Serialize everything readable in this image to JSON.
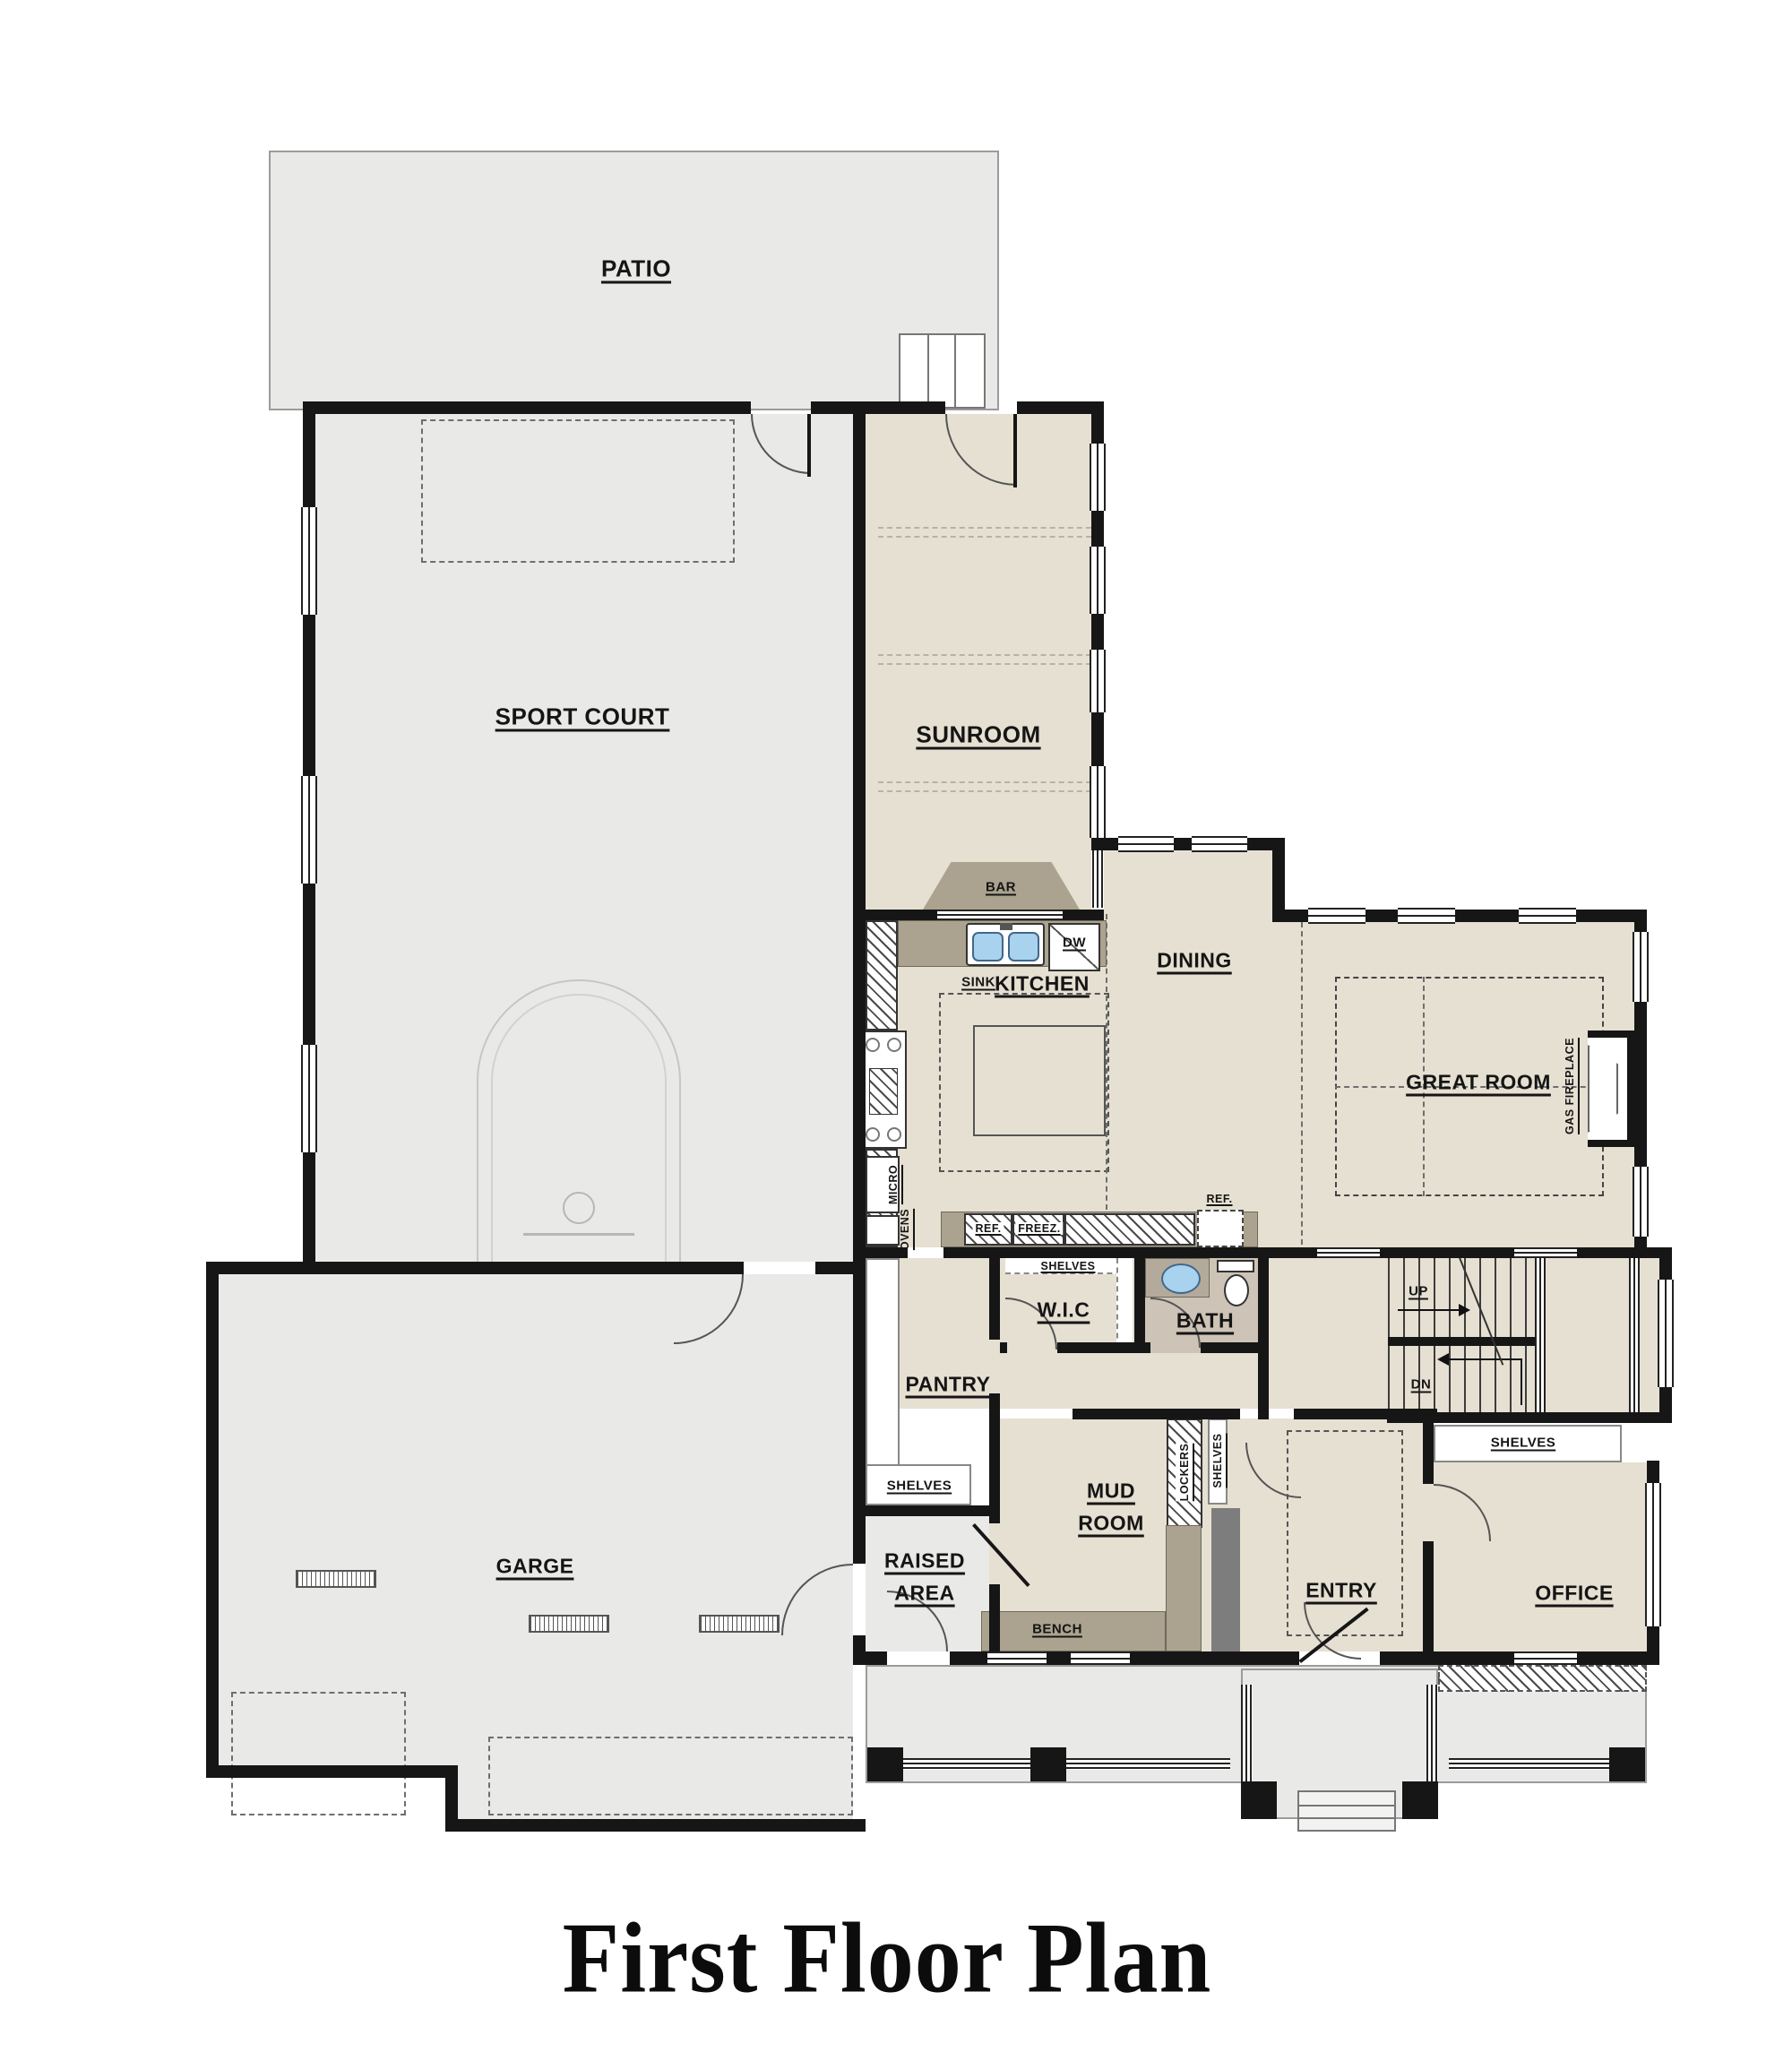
{
  "title": "First Floor Plan",
  "labels": {
    "patio": "PATIO",
    "sport_court": "SPORT COURT",
    "sunroom": "SUNROOM",
    "bar": "BAR",
    "sink": "SINK",
    "dw": "DW",
    "kitchen": "KITCHEN",
    "dining": "DINING",
    "great_room": "GREAT ROOM",
    "gas_fireplace": "GAS FIREPLACE",
    "ref_kitchen": "REF.",
    "freez": "FREEZ.",
    "ref_hall": "REF.",
    "shelves_wic": "SHELVES",
    "wic": "W.I.C",
    "bath": "BATH",
    "pantry": "PANTRY",
    "shelves_pantry": "SHELVES",
    "micro": "MICRO",
    "ovens": "OVENS",
    "up": "UP",
    "dn": "DN",
    "shelves_hall": "SHELVES",
    "lockers": "LOCKERS",
    "shelves_mud": "SHELVES",
    "mud_line1": "MUD",
    "mud_line2": "ROOM",
    "bench": "BENCH",
    "raised_line1": "RAISED",
    "raised_line2": "AREA",
    "entry": "ENTRY",
    "office": "OFFICE",
    "garage": "GARGE"
  },
  "colors": {
    "wall": "#161616",
    "exterior_floor": "#e9e9e8",
    "interior_floor": "#e6e0d2",
    "bath_floor": "#cdc3b6",
    "counter": "#aba28f",
    "sink_blue": "#a8d2ee",
    "gray_partition": "#7d7d7d"
  }
}
